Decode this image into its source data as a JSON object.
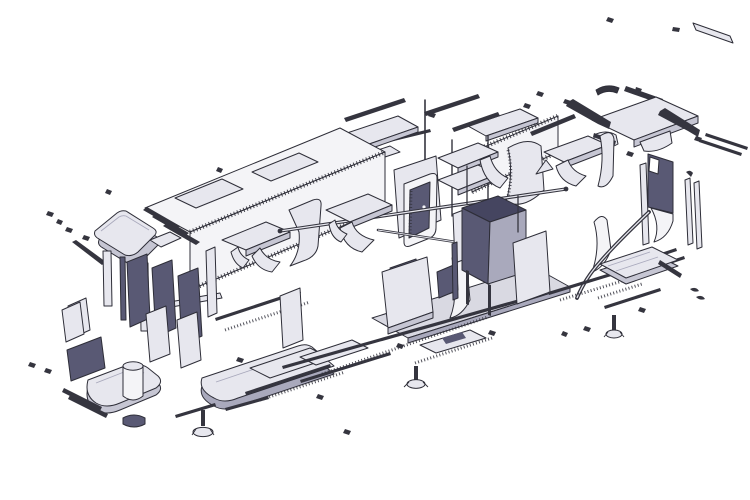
{
  "figure": {
    "type": "exploded-isometric-assembly-drawing",
    "subject": "modular-vehicle-body",
    "background": "#ffffff"
  },
  "canvas": {
    "width": 750,
    "height": 500
  },
  "colors": {
    "background": "#ffffff",
    "outline": "#2e2e38",
    "white": "#ffffff",
    "panel_lighter": "#f4f4f7",
    "panel_light": "#e7e7ee",
    "panel_mid": "#c6c6d3",
    "panel_shade": "#a9a9bc",
    "floor": "#d9d9e2",
    "panel_dark": "#595974",
    "panel_darker": "#454560",
    "rail": "#35353f"
  },
  "parts": [
    "top-right-roof-panel-assembly",
    "ceiling-panels",
    "main-body-shell",
    "roof-skylight-openings",
    "wall-luggage-rack",
    "right-shell-segment",
    "left-roof-end-cap",
    "support-posts",
    "dark-door-panels",
    "left-end-base-platform",
    "cylindrical-tank",
    "mid-floor-platform",
    "central-floor-platform",
    "door-frame-with-window",
    "handrail-tubes",
    "overhead-luggage-racks",
    "open-top-storage-box",
    "right-door-panel-with-window",
    "flared-wall-panels",
    "right-floor-slab",
    "leveling-feet",
    "floor-rails",
    "fasteners-and-screws"
  ]
}
